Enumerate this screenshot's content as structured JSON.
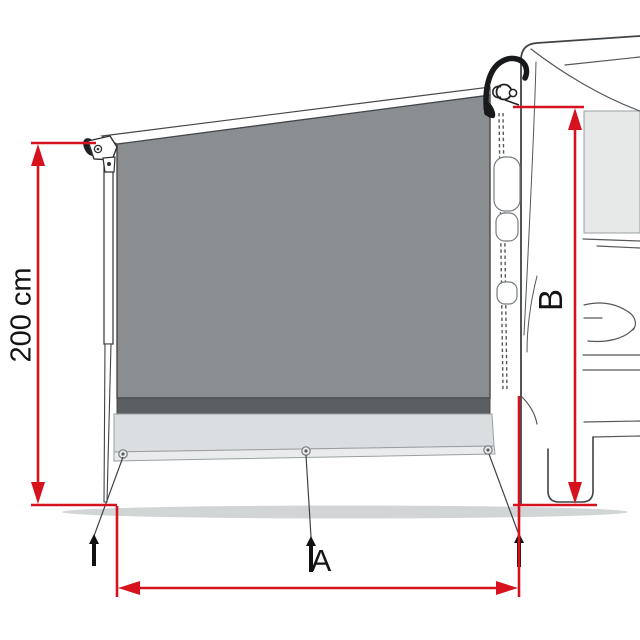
{
  "diagram": {
    "name": "awning-side-panel-dimension-diagram",
    "description": "Line-art technical drawing of an awning side panel mounted between a vehicle and a support leg, with red dimension arrows",
    "labels": {
      "height": "200 cm",
      "span": "A",
      "rear_height": "B"
    },
    "colors": {
      "dimension_red": "#d6121f",
      "panel_fabric": "#8a8e91",
      "panel_band": "#5b5f61",
      "panel_skirt": "#dbdee0",
      "panel_hem": "#e9ebec",
      "ground_shadow": "#d2d5d5",
      "vehicle_window": "#e7e9e9",
      "line_art": "#3f4346",
      "text": "#141414"
    }
  }
}
